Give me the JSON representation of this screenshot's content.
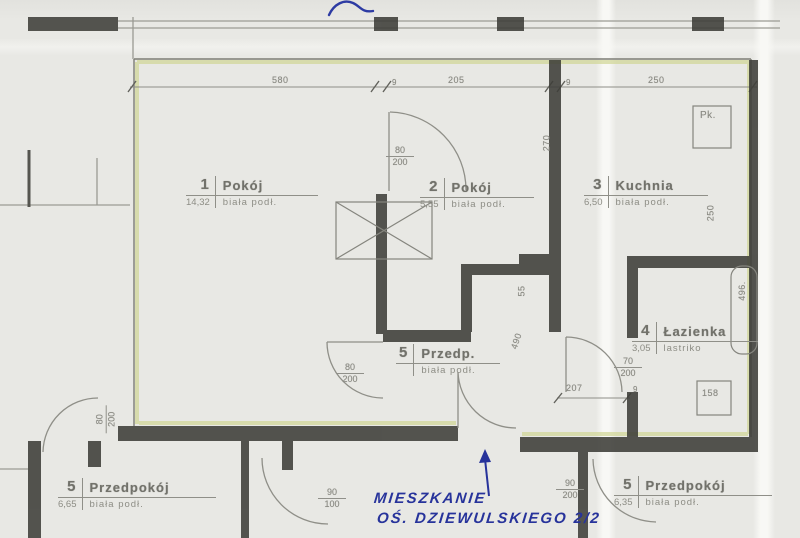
{
  "palette": {
    "paper": "#e8e8e4",
    "wall": "#3e3e39",
    "pencil": "#8a8a83",
    "highlight": "#d0d594",
    "ink_blue": "#27339b"
  },
  "rooms": {
    "room1": {
      "number": "1",
      "name": "Pokój",
      "area": "14,32",
      "floor": "biała podł."
    },
    "room2": {
      "number": "2",
      "name": "Pokój",
      "area": "5,55",
      "floor": "biała podł."
    },
    "kitchen": {
      "number": "3",
      "name": "Kuchnia",
      "area": "6,50",
      "floor": "biała podł."
    },
    "bathroom": {
      "number": "4",
      "name": "Łazienka",
      "area": "3,05",
      "floor": "lastriko"
    },
    "hall": {
      "number": "5",
      "name": "Przedp.",
      "area": "",
      "floor": "biała podł."
    },
    "neighbor_left": {
      "number": "5",
      "name": "Przedpokój",
      "area": "6,65",
      "floor": "biała podł."
    },
    "neighbor_right": {
      "number": "5",
      "name": "Przedpokój",
      "area": "6,35",
      "floor": "biała podł."
    }
  },
  "dims": {
    "top_left": "580",
    "top_mid": "205",
    "top_right": "250",
    "tick_a": "9",
    "tick_b": "9",
    "tick_c": "9",
    "door_room2": {
      "top": "80",
      "bottom": "200"
    },
    "door_hall": {
      "top": "80",
      "bottom": "200"
    },
    "door_left": {
      "top": "80",
      "bottom": "200"
    },
    "door_bath": {
      "top": "70",
      "bottom": "200"
    },
    "door_bottom_mid": {
      "top": "90",
      "bottom": "100"
    },
    "door_bottom_right": {
      "top": "90",
      "bottom": "200"
    },
    "wall_270": "270",
    "wall_55": "55",
    "wall_490": "490",
    "kitchen_250": "250",
    "bath_496": "496.",
    "corridor_207": "207",
    "bath_158": "158",
    "pantry": "Pk."
  },
  "annotation": {
    "line1": "MIESZKANIE",
    "line2": "OŚ. DZIEWULSKIEGO 2/2"
  }
}
